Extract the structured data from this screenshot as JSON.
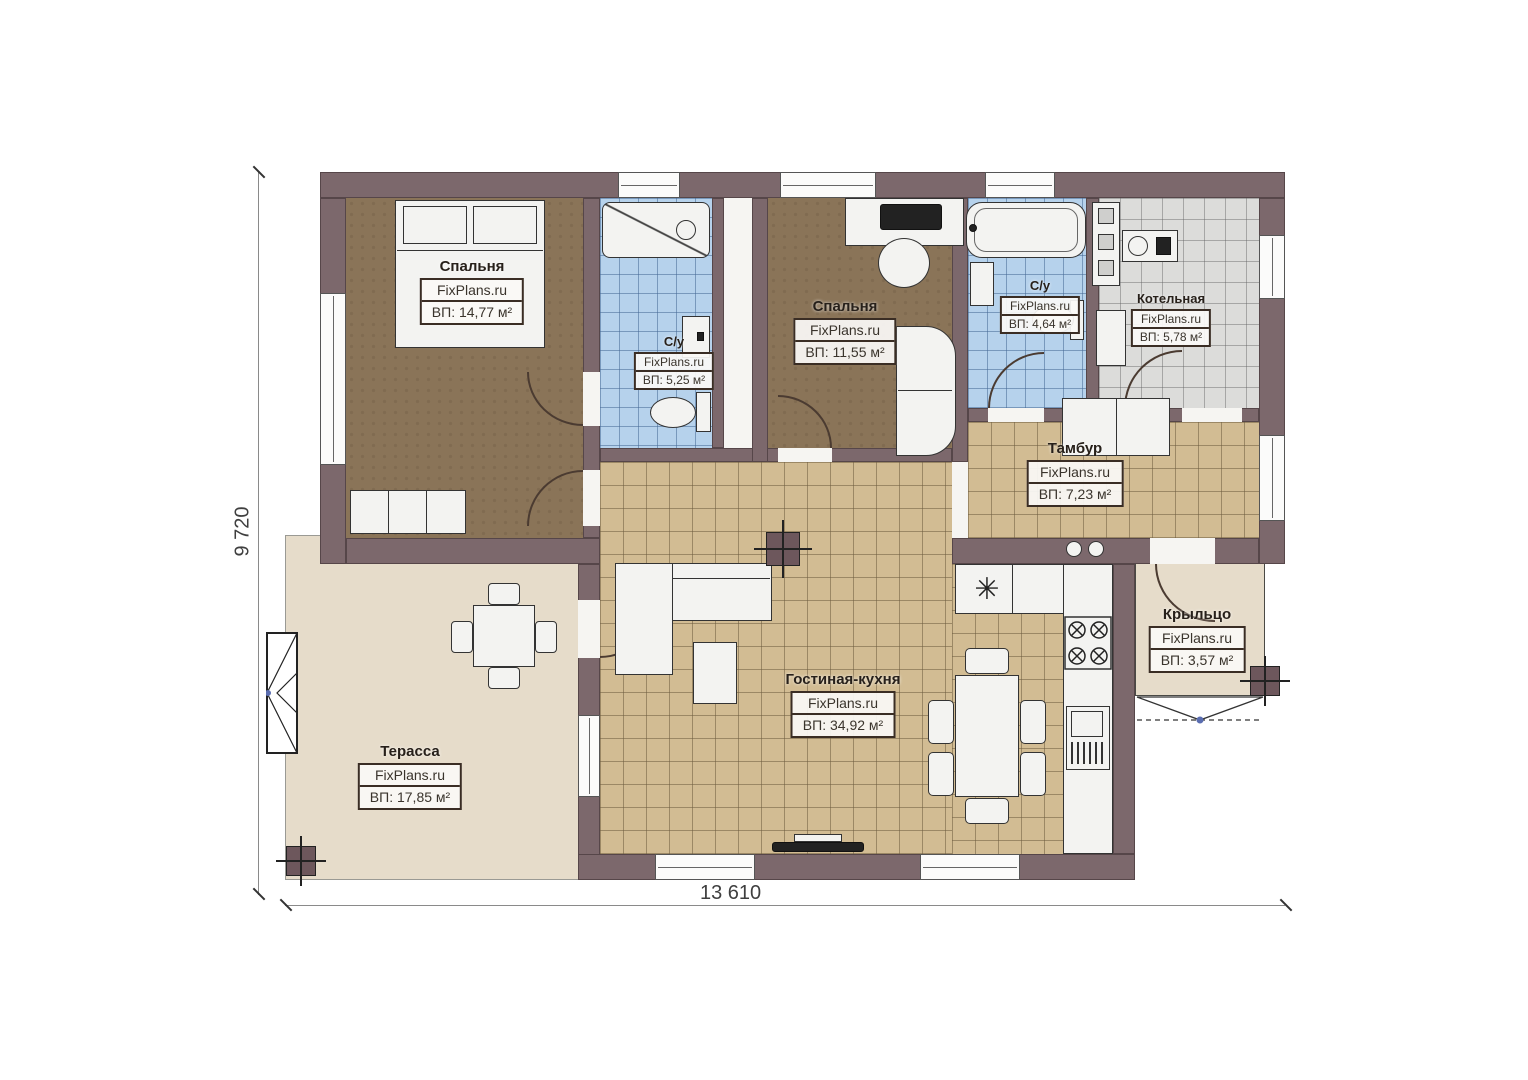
{
  "brand": "FixPlans.ru",
  "rooms": {
    "bedroom1": {
      "name": "Спальня",
      "brand": "FixPlans.ru",
      "area": "ВП: 14,77 м²"
    },
    "bath1": {
      "name": "С/у",
      "brand": "FixPlans.ru",
      "area": "ВП: 5,25 м²"
    },
    "bedroom2": {
      "name": "Спальня",
      "brand": "FixPlans.ru",
      "area": "ВП: 11,55 м²"
    },
    "bath2": {
      "name": "С/у",
      "brand": "FixPlans.ru",
      "area": "ВП: 4,64 м²"
    },
    "boiler": {
      "name": "Котельная",
      "brand": "FixPlans.ru",
      "area": "ВП: 5,78 м²"
    },
    "vestibule": {
      "name": "Тамбур",
      "brand": "FixPlans.ru",
      "area": "ВП: 7,23 м²"
    },
    "porch": {
      "name": "Крыльцо",
      "brand": "FixPlans.ru",
      "area": "ВП: 3,57 м²"
    },
    "living": {
      "name": "Гостиная-кухня",
      "brand": "FixPlans.ru",
      "area": "ВП: 34,92 м²"
    },
    "terrace": {
      "name": "Терасса",
      "brand": "FixPlans.ru",
      "area": "ВП: 17,85 м²"
    }
  },
  "dimensions": {
    "bottom": "13 610",
    "left": "9 720"
  },
  "colors": {
    "wall": "#7c686c",
    "floor_wood": "#8a7458",
    "tile_blue": "#b6d2ec",
    "tile_tan": "#d2bc93",
    "tile_gray": "#dcdcda",
    "floor_outdoor": "#e6dcca"
  }
}
